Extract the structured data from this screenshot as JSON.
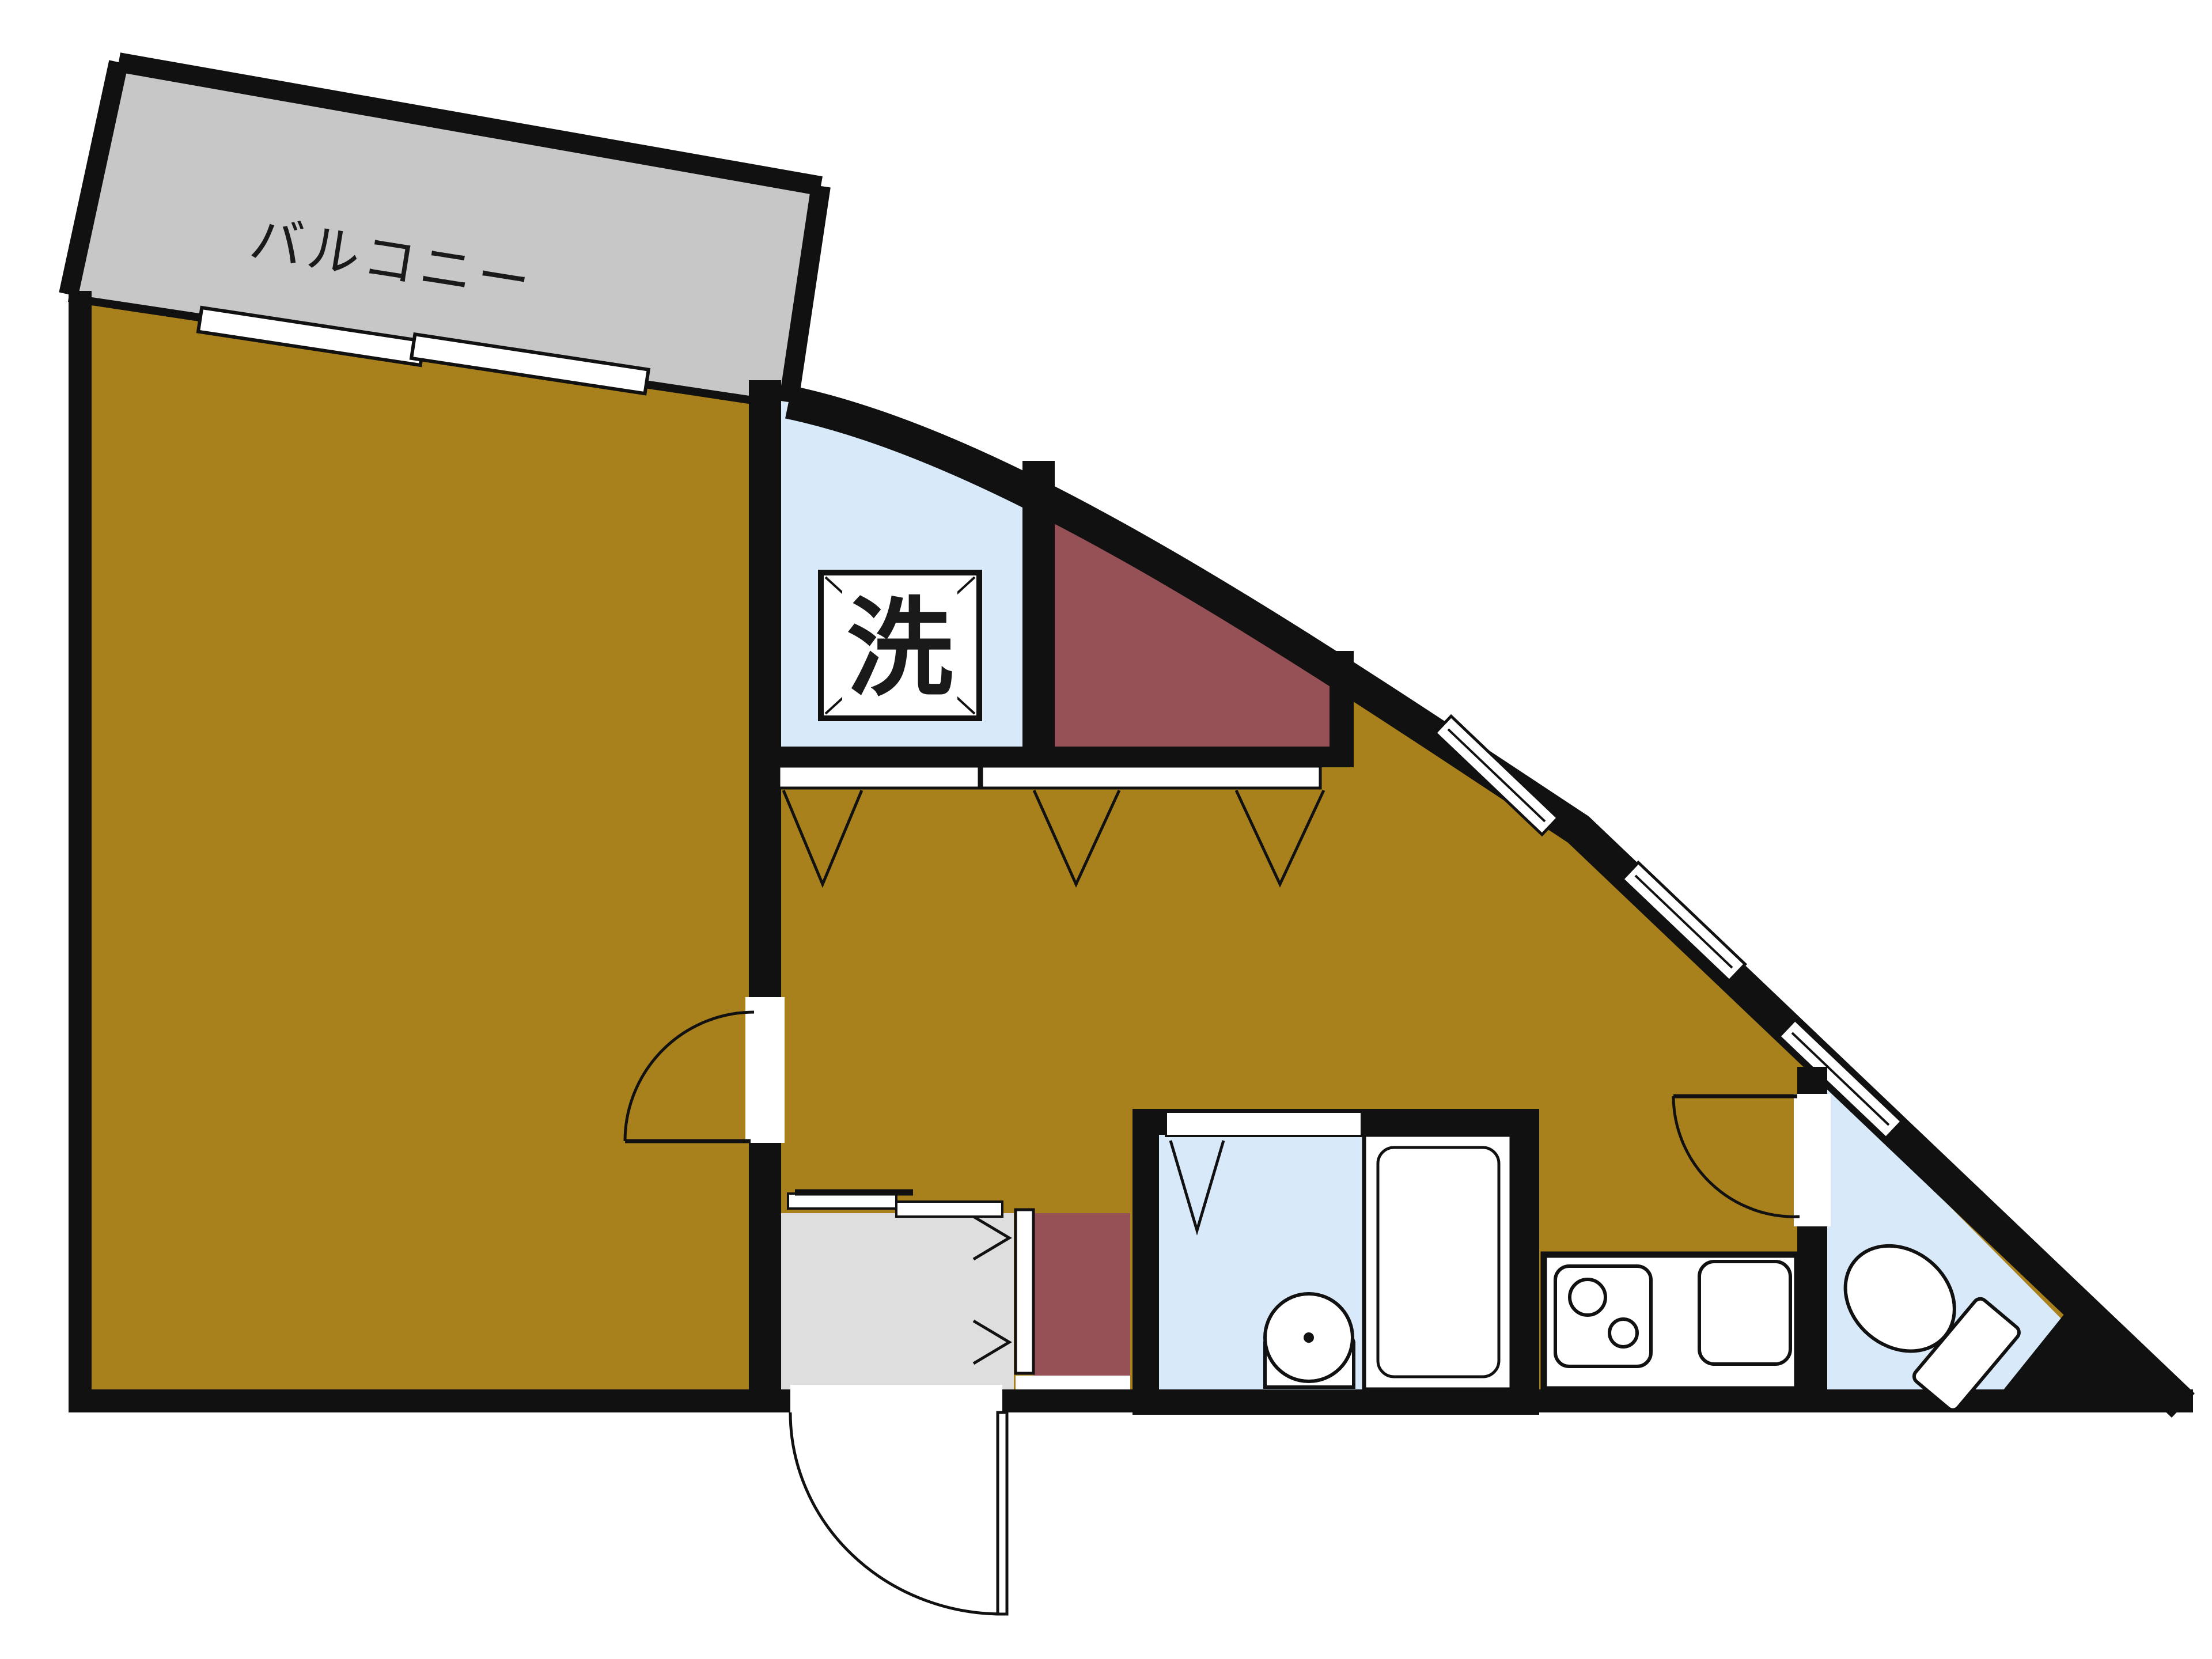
{
  "labels": {
    "balcony": "バルコニー",
    "washer": "洗"
  },
  "colors": {
    "wall": "#111111",
    "room_floor": "#a8801c",
    "closet": "#965157",
    "wet_area": "#d8eaf9",
    "balcony": "#c7c7c7",
    "entrance": "#dedede",
    "fixture": "#ffffff",
    "background": "#ffffff",
    "label_text": "#1a1a1a"
  }
}
